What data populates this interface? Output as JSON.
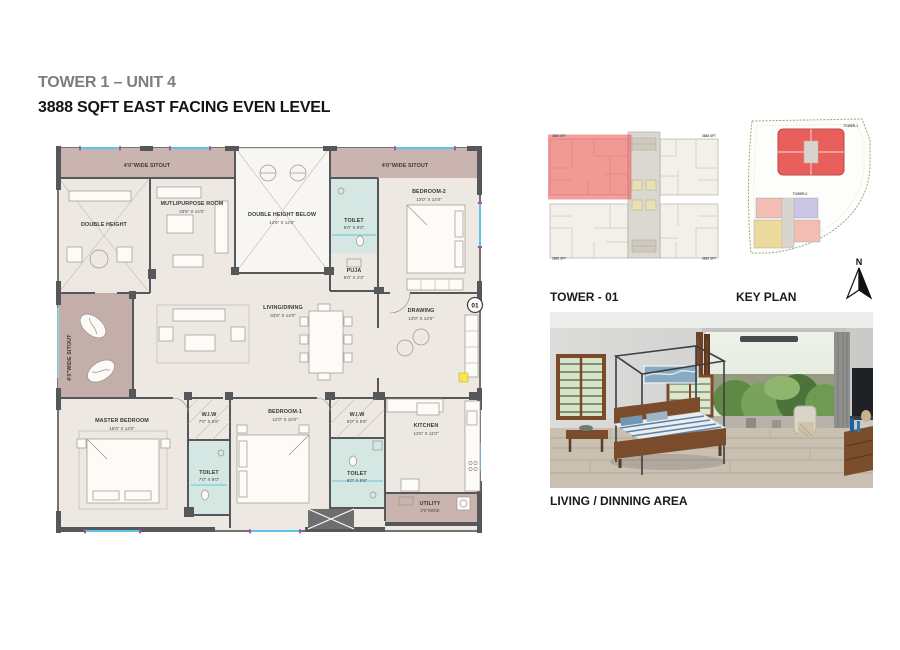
{
  "page": {
    "title": "TOWER 1 – UNIT 4",
    "subtitle": "3888 SQFT EAST FACING EVEN LEVEL"
  },
  "floor_plan": {
    "sitout_label": "4'0\"WIDE SITOUT",
    "rooms": {
      "double_height": {
        "name": "DOUBLE HEIGHT"
      },
      "multipurpose": {
        "name": "MUTLIPURPOSE ROOM",
        "dim": "23'6\" X 14'0\""
      },
      "double_height_below": {
        "name": "DOUBLE HEIGHT BELOW",
        "dim": "12'6\" X 14'0\""
      },
      "toilet2": {
        "name": "TOILET",
        "dim": "6'0\" X 9'0\""
      },
      "puja": {
        "name": "PUJA",
        "dim": "6'0\" X 4'3\""
      },
      "bedroom2": {
        "name": "BEDROOM-2",
        "dim": "13'0\" X 14'0\""
      },
      "living_dining": {
        "name": "LIVING/DINING",
        "dim": "33'6\" X 14'0\""
      },
      "drawing": {
        "name": "DRAWING",
        "dim": "13'0\" X 14'0\""
      },
      "master_bedroom": {
        "name": "MASTER BEDROOM",
        "dim": "16'0\" X 14'0\""
      },
      "wiw_master": {
        "name": "W.I.W",
        "dim": "7'0\" X 5'6\""
      },
      "toilet_master": {
        "name": "TOILET",
        "dim": "7'0\" X 9'0\""
      },
      "bedroom1": {
        "name": "BEDROOM-1",
        "dim": "12'0\" X 15'0\""
      },
      "wiw_bed1": {
        "name": "W.I.W",
        "dim": "6'0\" X 5'6\""
      },
      "toilet1": {
        "name": "TOILET",
        "dim": "6'0\" X 9'6\""
      },
      "kitchen": {
        "name": "KITCHEN",
        "dim": "13'6\" X 11'0\""
      },
      "utility": {
        "name": "UTILITY",
        "dim": "3'0\"WIDE"
      }
    },
    "unit_number": "01"
  },
  "key_plan": {
    "tower_label": "TOWER - 01",
    "keyplan_label": "KEY PLAN",
    "north_label": "N",
    "unit_area_label": "3888 SFT",
    "site": {
      "tower1_label": "TOWER-1",
      "tower2_label": "TOWER-2"
    }
  },
  "photo": {
    "caption": "LIVING / DINNING AREA"
  },
  "colors": {
    "title_gray": "#7b7d80",
    "sitout_mauve": "#c9b4af",
    "toilet_cyan": "#d5e7e3",
    "room_floor": "#ede9e2",
    "wall_dark": "#56575a",
    "window_blue": "#5ec3e6",
    "window_purple": "#9c59a3",
    "highlight_red": "#ef5350"
  }
}
